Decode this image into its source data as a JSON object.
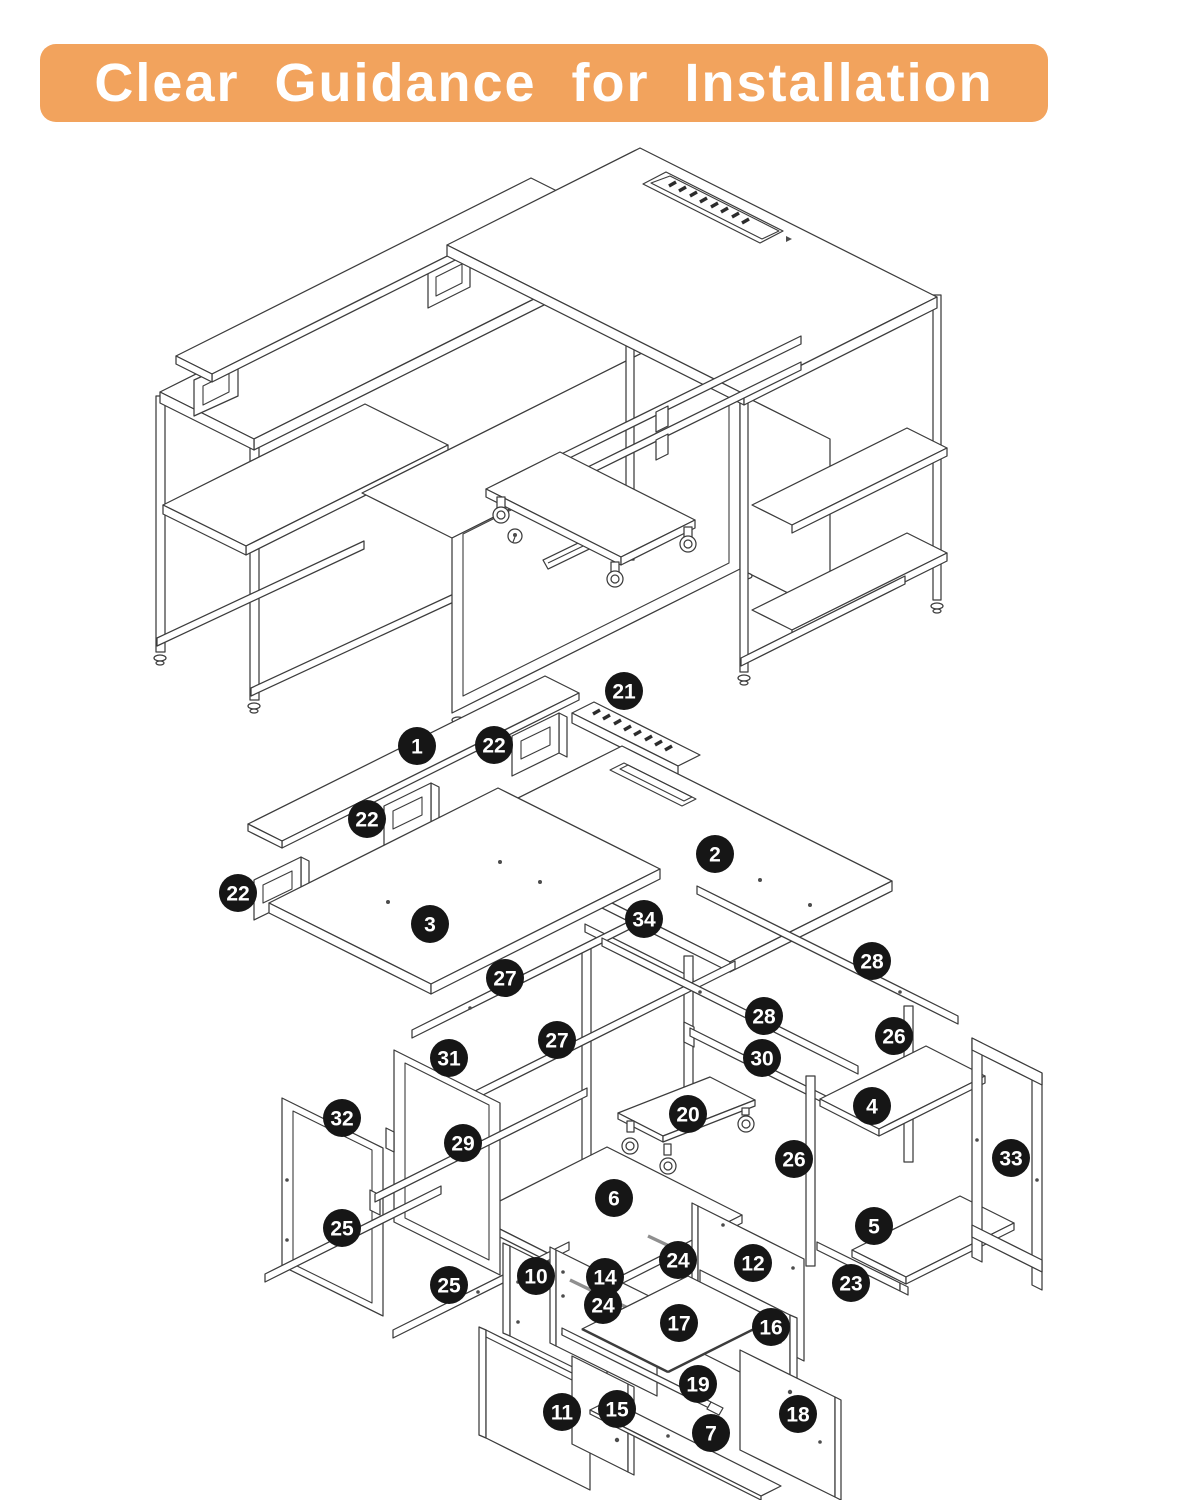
{
  "banner": {
    "title": "Clear Guidance for Installation",
    "bg": "#F2A35D",
    "text_color": "#FFFFFF"
  },
  "diagram": {
    "description": "Exploded isometric assembly diagram of an L-shaped desk with monitor stand, file drawer, CPU stand and storage shelves",
    "line_color": "#3c3c3c",
    "badge": {
      "bg": "#161616",
      "text_color": "#FFFFFF",
      "radius": 19
    },
    "callouts": [
      {
        "n": "1",
        "x": 417,
        "y": 746
      },
      {
        "n": "2",
        "x": 715,
        "y": 854
      },
      {
        "n": "3",
        "x": 430,
        "y": 924
      },
      {
        "n": "4",
        "x": 872,
        "y": 1106
      },
      {
        "n": "5",
        "x": 874,
        "y": 1226
      },
      {
        "n": "6",
        "x": 614,
        "y": 1198
      },
      {
        "n": "7",
        "x": 711,
        "y": 1433
      },
      {
        "n": "10",
        "x": 536,
        "y": 1276
      },
      {
        "n": "11",
        "x": 562,
        "y": 1412
      },
      {
        "n": "12",
        "x": 753,
        "y": 1263
      },
      {
        "n": "14",
        "x": 605,
        "y": 1277
      },
      {
        "n": "15",
        "x": 617,
        "y": 1409
      },
      {
        "n": "16",
        "x": 771,
        "y": 1327
      },
      {
        "n": "17",
        "x": 679,
        "y": 1323
      },
      {
        "n": "18",
        "x": 798,
        "y": 1414
      },
      {
        "n": "19",
        "x": 698,
        "y": 1384
      },
      {
        "n": "20",
        "x": 688,
        "y": 1114
      },
      {
        "n": "21",
        "x": 624,
        "y": 691
      },
      {
        "n": "22",
        "x": 494,
        "y": 745
      },
      {
        "n": "22",
        "x": 367,
        "y": 819
      },
      {
        "n": "22",
        "x": 238,
        "y": 893
      },
      {
        "n": "23",
        "x": 851,
        "y": 1283
      },
      {
        "n": "24",
        "x": 678,
        "y": 1260
      },
      {
        "n": "24",
        "x": 603,
        "y": 1305
      },
      {
        "n": "25",
        "x": 342,
        "y": 1228
      },
      {
        "n": "25",
        "x": 449,
        "y": 1285
      },
      {
        "n": "26",
        "x": 894,
        "y": 1036
      },
      {
        "n": "26",
        "x": 794,
        "y": 1159
      },
      {
        "n": "27",
        "x": 505,
        "y": 978
      },
      {
        "n": "27",
        "x": 557,
        "y": 1040
      },
      {
        "n": "28",
        "x": 872,
        "y": 961
      },
      {
        "n": "28",
        "x": 764,
        "y": 1016
      },
      {
        "n": "29",
        "x": 463,
        "y": 1143
      },
      {
        "n": "30",
        "x": 762,
        "y": 1058
      },
      {
        "n": "31",
        "x": 449,
        "y": 1058
      },
      {
        "n": "32",
        "x": 342,
        "y": 1118
      },
      {
        "n": "33",
        "x": 1011,
        "y": 1158
      },
      {
        "n": "34",
        "x": 644,
        "y": 919
      }
    ]
  }
}
